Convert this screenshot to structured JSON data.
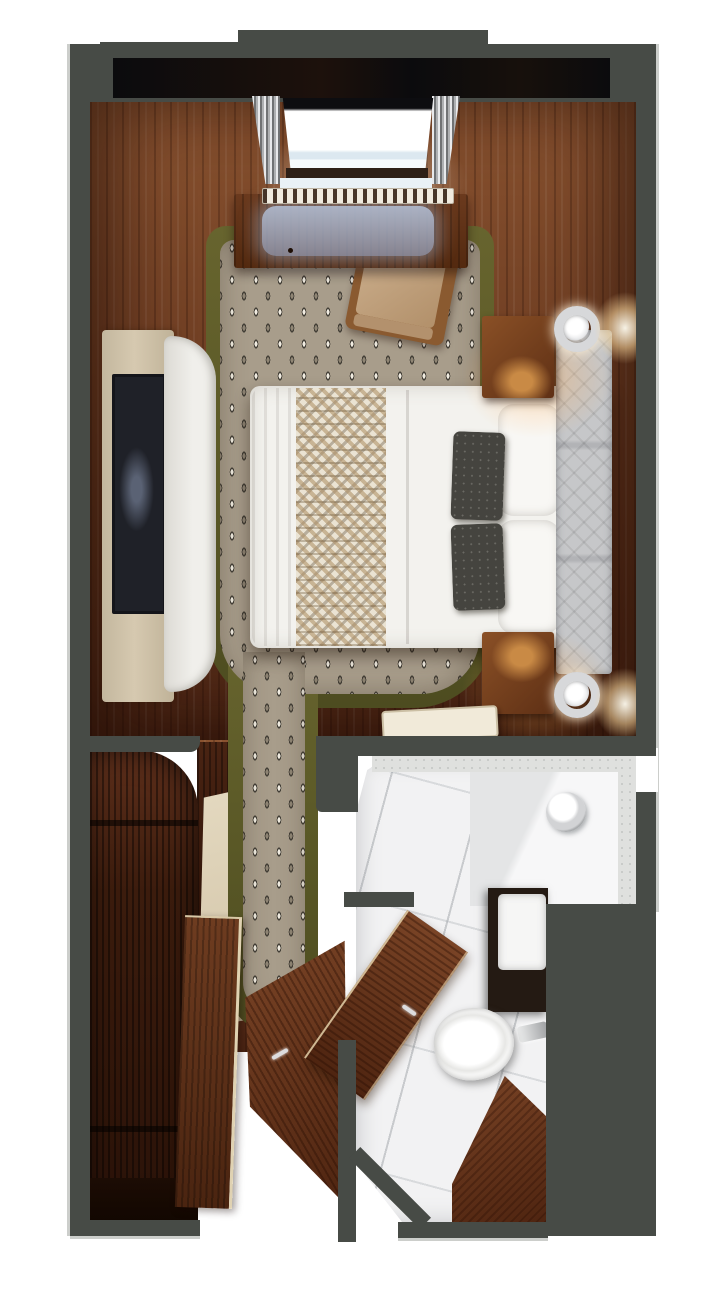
{
  "scene": {
    "title": "Stateroom floor plan — top-down 3D rendering",
    "view": "top-down",
    "render_style": "photorealistic 3D cutaway"
  },
  "palette": {
    "wall": "#474b46",
    "wall-edge": "#9a9d98",
    "window-band": "#0c0c0e",
    "wood-light": "#8a5330",
    "wood": "#6e3d22",
    "wood-dark": "#4a2413",
    "wood-deep": "#2e1308",
    "olive": "#5d5b28",
    "carpet-base": "#a89d8b",
    "carpet-dark": "#423e36",
    "carpet-light": "#f1ece1",
    "bed-white": "#f3f2ee",
    "runner-base": "#eae3d3",
    "runner-tan": "#b2946a",
    "pillow-dark": "#45443f",
    "headboard": "#c6c7c9",
    "cream": "#d6c9b0",
    "tv-screen": "#1f2128",
    "sofa-white": "#f0efeb",
    "marble": "#f2f2f3",
    "tile-gray": "#dfe0de",
    "vanity-dark": "#241a13",
    "porcelain": "#f6f6f5",
    "chrome": "#d7d8da",
    "glow-warm": "#ffcf97",
    "glass-blue": "#a9b3c2",
    "beige-light": "#d8cbb0",
    "sill-blue": "#e9f1f6"
  },
  "rooms": [
    {
      "id": "bedroom",
      "label": "Bedroom with queen bed"
    },
    {
      "id": "hallway",
      "label": "Entry hallway"
    },
    {
      "id": "bathroom",
      "label": "Bathroom with shower, toilet and vanity"
    },
    {
      "id": "closet",
      "label": "Wardrobe closet"
    }
  ],
  "furniture": {
    "window": {
      "label": "Picture window with curtains and sill"
    },
    "desk": {
      "label": "Writing desk with glass inlay"
    },
    "chair": {
      "label": "Desk chair"
    },
    "bed": {
      "label": "Queen bed with white duvet, patterned runner and charcoal accent pillows"
    },
    "headboard": {
      "label": "Upholstered headboard"
    },
    "nightstand_top": {
      "label": "Nightstand with wall sconce"
    },
    "nightstand_bottom": {
      "label": "Nightstand with wall sconce"
    },
    "tv": {
      "label": "Wall-mounted TV"
    },
    "console": {
      "label": "TV console cabinet"
    },
    "sofa": {
      "label": "Curved settee"
    },
    "closet": {
      "label": "Open wardrobe with shelves"
    },
    "entry_door": {
      "label": "Entry door, ajar"
    },
    "bathroom_door": {
      "label": "Bathroom door, open"
    },
    "toilet": {
      "label": "Toilet"
    },
    "vanity": {
      "label": "Vanity with sink"
    },
    "shower_bench": {
      "label": "Shower with marble bench"
    },
    "tray": {
      "label": "Serving tray"
    }
  }
}
